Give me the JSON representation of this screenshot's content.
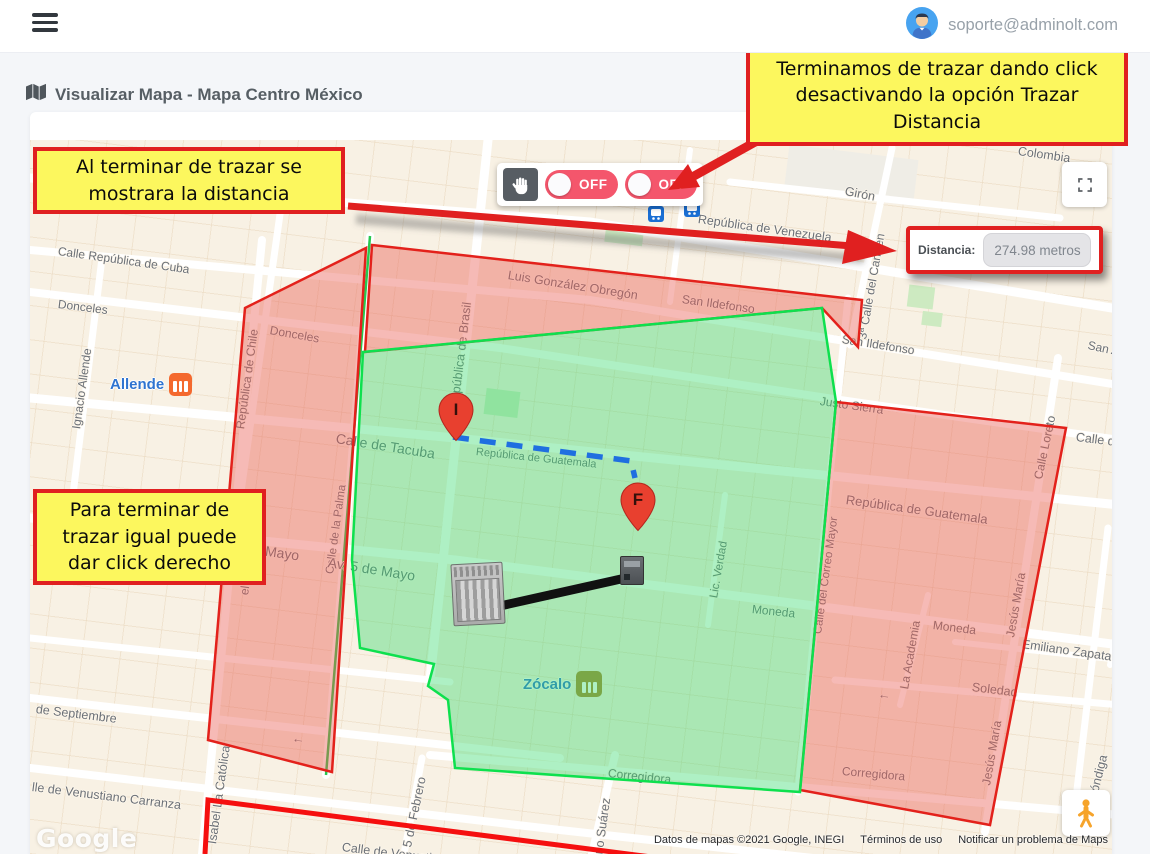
{
  "topbar": {
    "email": "soporte@adminolt.com"
  },
  "page": {
    "title": "Visualizar Mapa - Mapa Centro México"
  },
  "annotations": {
    "box_top_right": "Terminamos de trazar dando click desactivando la opción Trazar Distancia",
    "box_top_left": "Al terminar de trazar se mostrara la distancia",
    "box_left": "Para terminar de trazar igual puede dar click derecho"
  },
  "controls": {
    "hand_tool_icon": "hand-icon",
    "toggles": [
      {
        "label": "OFF",
        "state": "off"
      },
      {
        "label": "OFF",
        "state": "off"
      }
    ]
  },
  "distance": {
    "label": "Distancia:",
    "value": "274.98 metros"
  },
  "markers": [
    {
      "letter": "I"
    },
    {
      "letter": "F"
    }
  ],
  "map": {
    "watermark": "Google",
    "attribution": [
      "Datos de mapas ©2021 Google, INEGI",
      "Términos de uso",
      "Notificar un problema de Maps"
    ],
    "stations": [
      {
        "name": "Allende"
      },
      {
        "name": "Zócalo"
      }
    ],
    "street_labels": [
      {
        "text": "Belisario Domínguez",
        "x": 53,
        "y": 28,
        "rot": 8,
        "size": 12.5
      },
      {
        "text": "República de Brasil",
        "x": 424,
        "y": 262,
        "rot": -83,
        "size": 12.5
      },
      {
        "text": "República de Venezuela",
        "x": 668,
        "y": 72,
        "rot": 8,
        "size": 12.5
      },
      {
        "text": "Girón",
        "x": 815,
        "y": 44,
        "rot": 11,
        "size": 12.5
      },
      {
        "text": "Colombia",
        "x": 988,
        "y": 4,
        "rot": 8,
        "size": 12.5
      },
      {
        "text": "3ª Calle del Carmen",
        "x": 832,
        "y": 192,
        "rot": -80,
        "size": 12
      },
      {
        "text": "Calle República de Cuba",
        "x": 28,
        "y": 104,
        "rot": 8,
        "size": 12
      },
      {
        "text": "Luis González Obregón",
        "x": 478,
        "y": 128,
        "rot": 9,
        "size": 12.5
      },
      {
        "text": "San Ildefonso",
        "x": 652,
        "y": 152,
        "rot": 8,
        "size": 12
      },
      {
        "text": "San Ildefonso",
        "x": 812,
        "y": 192,
        "rot": 9,
        "size": 12
      },
      {
        "text": "San Anto",
        "x": 1058,
        "y": 198,
        "rot": 12,
        "size": 12
      },
      {
        "text": "Donceles",
        "x": 28,
        "y": 157,
        "rot": 7,
        "size": 12
      },
      {
        "text": "Donceles",
        "x": 240,
        "y": 183,
        "rot": 10,
        "size": 12
      },
      {
        "text": "Ignacio Allende",
        "x": 46,
        "y": 282,
        "rot": -82,
        "size": 12
      },
      {
        "text": "República de Chile",
        "x": 210,
        "y": 282,
        "rot": -82,
        "size": 12
      },
      {
        "text": "Calle de Tacuba",
        "x": 306,
        "y": 290,
        "rot": 9,
        "size": 14
      },
      {
        "text": "Calle de la Palma",
        "x": 300,
        "y": 428,
        "rot": -82,
        "size": 11.5
      },
      {
        "text": "República de Guatemala",
        "x": 446,
        "y": 306,
        "rot": 6,
        "size": 11
      },
      {
        "text": "República de Guatemala",
        "x": 816,
        "y": 352,
        "rot": 8,
        "size": 13
      },
      {
        "text": "Justo Sierra",
        "x": 790,
        "y": 254,
        "rot": 8,
        "size": 12
      },
      {
        "text": "Calle Loreto",
        "x": 1008,
        "y": 332,
        "rot": -78,
        "size": 12
      },
      {
        "text": "Calle de Mix",
        "x": 1046,
        "y": 290,
        "rot": 7,
        "size": 12.5
      },
      {
        "text": "Av. 5 de Mayo",
        "x": 298,
        "y": 414,
        "rot": 9,
        "size": 14
      },
      {
        "text": "de Mayo",
        "x": 216,
        "y": 400,
        "rot": 8,
        "size": 14
      },
      {
        "text": "Lic. Verdad",
        "x": 684,
        "y": 452,
        "rot": -80,
        "size": 11.5
      },
      {
        "text": "Moneda",
        "x": 722,
        "y": 462,
        "rot": 6,
        "size": 12
      },
      {
        "text": "Moneda",
        "x": 903,
        "y": 478,
        "rot": 7,
        "size": 12
      },
      {
        "text": "Soledad",
        "x": 942,
        "y": 540,
        "rot": 7,
        "size": 12.5
      },
      {
        "text": "Emiliano Zapata",
        "x": 992,
        "y": 497,
        "rot": 8,
        "size": 12.5
      },
      {
        "text": "La Academia",
        "x": 874,
        "y": 542,
        "rot": -80,
        "size": 12
      },
      {
        "text": "De La Santísima",
        "x": 1086,
        "y": 470,
        "rot": -72,
        "size": 12
      },
      {
        "text": "Jesús María",
        "x": 980,
        "y": 490,
        "rot": -80,
        "size": 12
      },
      {
        "text": "Jesús María",
        "x": 956,
        "y": 638,
        "rot": -80,
        "size": 12
      },
      {
        "text": "Calle del Correo Mayor",
        "x": 788,
        "y": 488,
        "rot": -82,
        "size": 11.5
      },
      {
        "text": "Corregidora",
        "x": 578,
        "y": 626,
        "rot": 6,
        "size": 12
      },
      {
        "text": "Corregidora",
        "x": 812,
        "y": 624,
        "rot": 5,
        "size": 12
      },
      {
        "text": "ino Suárez",
        "x": 568,
        "y": 710,
        "rot": -82,
        "size": 12.5
      },
      {
        "text": "de Septiembre",
        "x": 6,
        "y": 562,
        "rot": 7,
        "size": 12.5
      },
      {
        "text": "Isabel La Católica",
        "x": 182,
        "y": 697,
        "rot": -82,
        "size": 12.5
      },
      {
        "text": "5 de Febrero",
        "x": 377,
        "y": 700,
        "rot": -78,
        "size": 12.5
      },
      {
        "text": "lle de Venustiano Carranza",
        "x": 2,
        "y": 640,
        "rot": 7,
        "size": 12.5
      },
      {
        "text": "Calle de Venustiano Carranza",
        "x": 312,
        "y": 700,
        "rot": 7,
        "size": 12.5
      },
      {
        "text": "Alhóndiga",
        "x": 1060,
        "y": 662,
        "rot": -76,
        "size": 12.5
      },
      {
        "text": "el La Católica",
        "x": 214,
        "y": 448,
        "rot": -82,
        "size": 12
      },
      {
        "text": "←",
        "x": 848,
        "y": 546,
        "rot": 7,
        "size": 13
      },
      {
        "text": "←",
        "x": 262,
        "y": 590,
        "rot": 7,
        "size": 13
      },
      {
        "text": "↓",
        "x": 642,
        "y": 26,
        "rot": 6,
        "size": 13
      }
    ]
  },
  "colors": {
    "annotation_red": "#E02020",
    "annotation_yellow": "#FCF75E",
    "toggle_pink": "#F4566C",
    "zone_green_border": "#0EE04E",
    "zone_red_border": "#E3211B",
    "marker_red": "#E8402F"
  }
}
